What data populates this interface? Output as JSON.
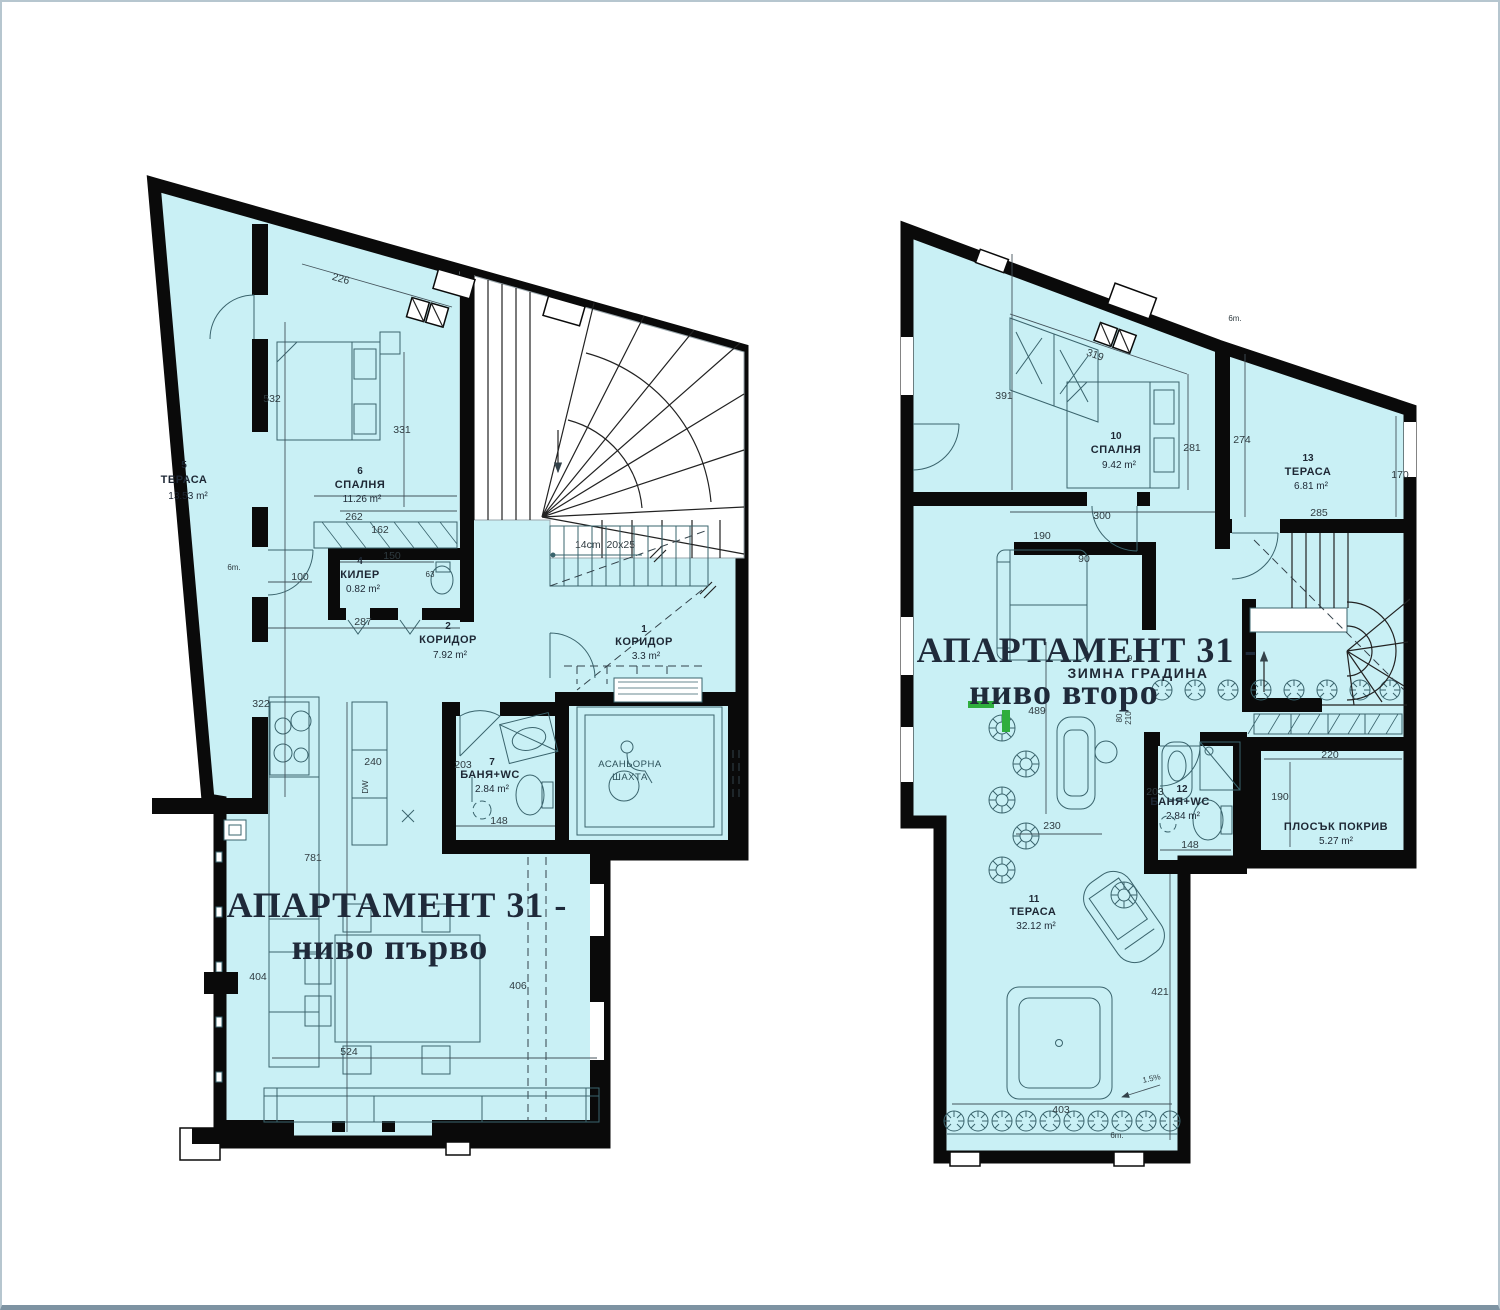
{
  "page": {
    "background": "#ffffff",
    "border_color": "#b6c6cf"
  },
  "colors": {
    "room_fill": "#c9f0f5",
    "wall": "#0a0a0a",
    "furniture_line": "#3a646d",
    "dimension_text": "#2f3b40",
    "title_text": "#1f2a3a",
    "accent_green": "#2fae3e"
  },
  "plans": [
    {
      "title_line1": "АПАРТАМЕНТ 31 -",
      "title_line2": "ниво първо",
      "rooms": {
        "r5": {
          "num": "5",
          "name": "ТЕРАСА",
          "area": "13.53 m²"
        },
        "r6": {
          "num": "6",
          "name": "СПАЛНЯ",
          "area": "11.26 m²"
        },
        "r4": {
          "num": "4",
          "name": "КИЛЕР",
          "area": "0.82 m²"
        },
        "r2": {
          "num": "2",
          "name": "КОРИДОР",
          "area": "7.92 m²"
        },
        "r1": {
          "num": "1",
          "name": "КОРИДОР",
          "area": "3.3 m²"
        },
        "r7": {
          "num": "7",
          "name": "БАНЯ+WC",
          "area": "2.84 m²"
        },
        "shaft": {
          "name_line1": "АСАНЬОРНА",
          "name_line2": "ШАХТА"
        }
      },
      "dims": {
        "d226": "226",
        "d532": "532",
        "d331": "331",
        "d262": "262",
        "d162": "162",
        "d150": "150",
        "d100": "100",
        "d287": "287",
        "d322": "322",
        "d240": "240",
        "d203": "203",
        "d148": "148",
        "d63": "63",
        "d781": "781",
        "d404": "404",
        "d406": "406",
        "d524": "524"
      },
      "notes": {
        "stair": "14cm. 20x25",
        "door": "6m.",
        "dw": "DW"
      }
    },
    {
      "title_line1": "АПАРТАМЕНТ 31 -",
      "title_line2": "ниво второ",
      "rooms": {
        "r10": {
          "num": "10",
          "name": "СПАЛНЯ",
          "area": "9.42 m²"
        },
        "r13": {
          "num": "13",
          "name": "ТЕРАСА",
          "area": "6.81 m²"
        },
        "r9": {
          "num": "9",
          "name": "ЗИМНА ГРАДИНА"
        },
        "r12": {
          "num": "12",
          "name": "БАНЯ+WC",
          "area": "2.84 m²"
        },
        "roof": {
          "name": "ПЛОСЪК ПОКРИВ",
          "area": "5.27 m²"
        },
        "r11": {
          "num": "11",
          "name": "ТЕРАСА",
          "area": "32.12 m²"
        }
      },
      "dims": {
        "d319": "319",
        "d391": "391",
        "d281": "281",
        "d274": "274",
        "d170": "170",
        "d300": "300",
        "d285": "285",
        "d190a": "190",
        "d90": "90",
        "d489": "489",
        "d230": "230",
        "d203": "203",
        "d148": "148",
        "d220": "220",
        "d190b": "190",
        "d421": "421",
        "d403": "403",
        "d80": "80",
        "d210": "210"
      },
      "notes": {
        "door_top": "6m.",
        "door_bottom": "6m.",
        "slope": "1.5%"
      }
    }
  ]
}
